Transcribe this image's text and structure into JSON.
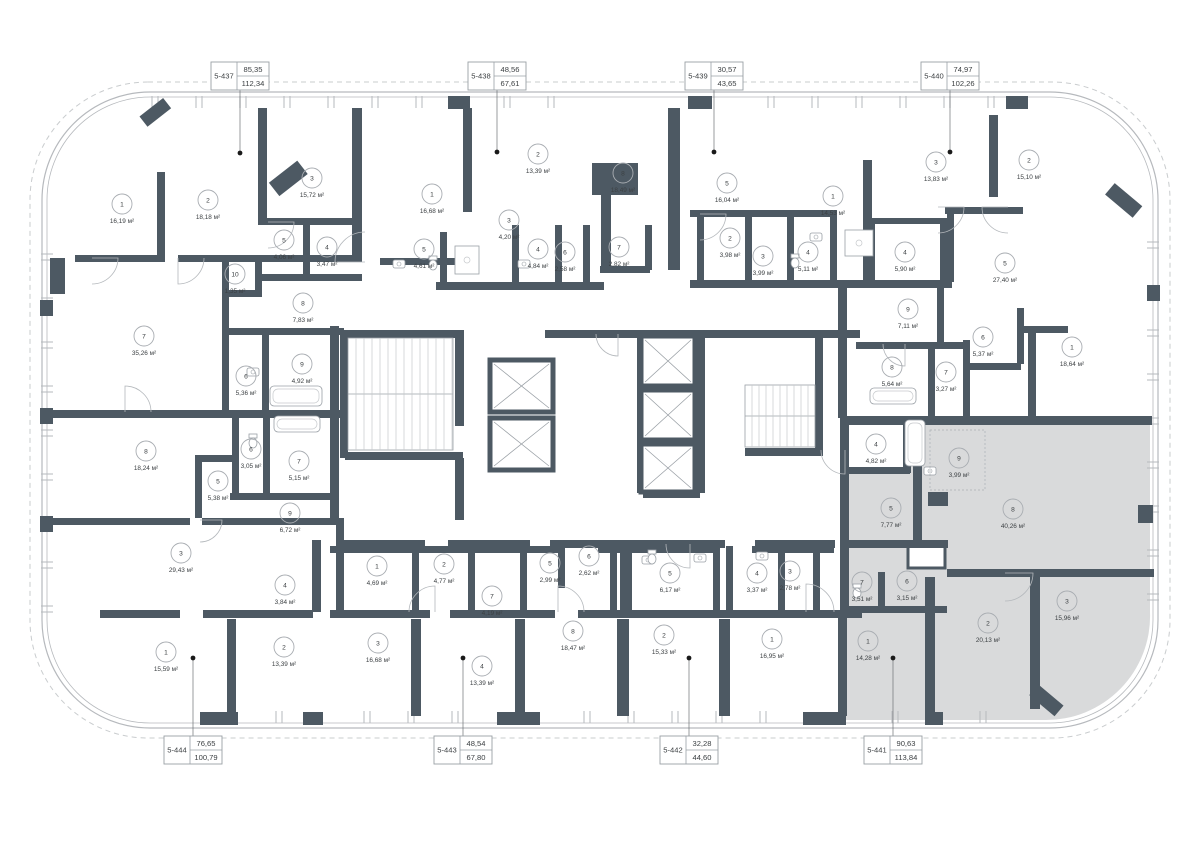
{
  "plan": {
    "unit": "м²",
    "highlight_color": "#d9dadb",
    "wall_color": "#4d5963",
    "apartments": [
      {
        "id": "5-437",
        "area_top": "85,35",
        "area_bottom": "112,34",
        "side": "top",
        "cx": 240,
        "dot_y": 153,
        "highlighted": false
      },
      {
        "id": "5-438",
        "area_top": "48,56",
        "area_bottom": "67,61",
        "side": "top",
        "cx": 497,
        "dot_y": 152,
        "highlighted": false
      },
      {
        "id": "5-439",
        "area_top": "30,57",
        "area_bottom": "43,65",
        "side": "top",
        "cx": 714,
        "dot_y": 152,
        "highlighted": false
      },
      {
        "id": "5-440",
        "area_top": "74,97",
        "area_bottom": "102,26",
        "side": "top",
        "cx": 950,
        "dot_y": 152,
        "highlighted": false
      },
      {
        "id": "5-444",
        "area_top": "76,65",
        "area_bottom": "100,79",
        "side": "bottom",
        "cx": 193,
        "dot_y": 658,
        "highlighted": false
      },
      {
        "id": "5-443",
        "area_top": "48,54",
        "area_bottom": "67,80",
        "side": "bottom",
        "cx": 463,
        "dot_y": 658,
        "highlighted": false
      },
      {
        "id": "5-442",
        "area_top": "32,28",
        "area_bottom": "44,60",
        "side": "bottom",
        "cx": 689,
        "dot_y": 658,
        "highlighted": false
      },
      {
        "id": "5-441",
        "area_top": "90,63",
        "area_bottom": "113,84",
        "side": "bottom",
        "cx": 893,
        "dot_y": 658,
        "highlighted": true
      }
    ],
    "rooms": [
      {
        "n": "1",
        "a": "16,19",
        "x": 122,
        "y": 204,
        "h": false
      },
      {
        "n": "2",
        "a": "18,18",
        "x": 208,
        "y": 200,
        "h": false
      },
      {
        "n": "3",
        "a": "15,72",
        "x": 312,
        "y": 178,
        "h": false
      },
      {
        "n": "5",
        "a": "4,06",
        "x": 284,
        "y": 240,
        "h": false
      },
      {
        "n": "4",
        "a": "3,47",
        "x": 327,
        "y": 247,
        "h": false
      },
      {
        "n": "10",
        "a": "1,35",
        "x": 235,
        "y": 274,
        "h": false
      },
      {
        "n": "8",
        "a": "7,83",
        "x": 303,
        "y": 303,
        "h": false
      },
      {
        "n": "1",
        "a": "16,68",
        "x": 432,
        "y": 194,
        "h": false
      },
      {
        "n": "5",
        "a": "4,61",
        "x": 424,
        "y": 249,
        "h": false
      },
      {
        "n": "2",
        "a": "13,39",
        "x": 538,
        "y": 154,
        "h": false
      },
      {
        "n": "3",
        "a": "4,20",
        "x": 509,
        "y": 220,
        "h": false
      },
      {
        "n": "4",
        "a": "4,84",
        "x": 538,
        "y": 249,
        "h": false
      },
      {
        "n": "6",
        "a": "2,58",
        "x": 565,
        "y": 252,
        "h": false
      },
      {
        "n": "8",
        "a": "18,49",
        "x": 623,
        "y": 173,
        "h": false
      },
      {
        "n": "7",
        "a": "2,82",
        "x": 619,
        "y": 247,
        "h": false
      },
      {
        "n": "5",
        "a": "16,04",
        "x": 727,
        "y": 183,
        "h": false
      },
      {
        "n": "2",
        "a": "3,98",
        "x": 730,
        "y": 238,
        "h": false
      },
      {
        "n": "3",
        "a": "3,99",
        "x": 763,
        "y": 256,
        "h": false
      },
      {
        "n": "4",
        "a": "5,11",
        "x": 808,
        "y": 252,
        "h": false
      },
      {
        "n": "1",
        "a": "14,53",
        "x": 833,
        "y": 196,
        "h": false
      },
      {
        "n": "4",
        "a": "5,90",
        "x": 905,
        "y": 252,
        "h": false
      },
      {
        "n": "3",
        "a": "13,83",
        "x": 936,
        "y": 162,
        "h": false
      },
      {
        "n": "2",
        "a": "15,10",
        "x": 1029,
        "y": 160,
        "h": false
      },
      {
        "n": "5",
        "a": "27,40",
        "x": 1005,
        "y": 263,
        "h": false
      },
      {
        "n": "9",
        "a": "7,11",
        "x": 908,
        "y": 309,
        "h": false
      },
      {
        "n": "6",
        "a": "5,37",
        "x": 983,
        "y": 337,
        "h": false
      },
      {
        "n": "1",
        "a": "18,64",
        "x": 1072,
        "y": 347,
        "h": false
      },
      {
        "n": "8",
        "a": "5,64",
        "x": 892,
        "y": 367,
        "h": false
      },
      {
        "n": "7",
        "a": "3,27",
        "x": 946,
        "y": 372,
        "h": false
      },
      {
        "n": "7",
        "a": "35,26",
        "x": 144,
        "y": 336,
        "h": false
      },
      {
        "n": "6",
        "a": "5,36",
        "x": 246,
        "y": 376,
        "h": false
      },
      {
        "n": "9",
        "a": "4,92",
        "x": 302,
        "y": 364,
        "h": false
      },
      {
        "n": "8",
        "a": "18,24",
        "x": 146,
        "y": 451,
        "h": false
      },
      {
        "n": "6",
        "a": "3,05",
        "x": 251,
        "y": 449,
        "h": false
      },
      {
        "n": "7",
        "a": "5,15",
        "x": 299,
        "y": 461,
        "h": false
      },
      {
        "n": "5",
        "a": "5,38",
        "x": 218,
        "y": 481,
        "h": false
      },
      {
        "n": "9",
        "a": "6,72",
        "x": 290,
        "y": 513,
        "h": false
      },
      {
        "n": "3",
        "a": "29,43",
        "x": 181,
        "y": 553,
        "h": false
      },
      {
        "n": "4",
        "a": "3,84",
        "x": 285,
        "y": 585,
        "h": false
      },
      {
        "n": "1",
        "a": "15,59",
        "x": 166,
        "y": 652,
        "h": false
      },
      {
        "n": "2",
        "a": "13,39",
        "x": 284,
        "y": 647,
        "h": false
      },
      {
        "n": "1",
        "a": "4,69",
        "x": 377,
        "y": 566,
        "h": false
      },
      {
        "n": "2",
        "a": "4,77",
        "x": 444,
        "y": 564,
        "h": false
      },
      {
        "n": "7",
        "a": "4,19",
        "x": 492,
        "y": 596,
        "h": false
      },
      {
        "n": "5",
        "a": "2,99",
        "x": 550,
        "y": 563,
        "h": false
      },
      {
        "n": "6",
        "a": "2,62",
        "x": 589,
        "y": 556,
        "h": false
      },
      {
        "n": "5",
        "a": "6,17",
        "x": 670,
        "y": 573,
        "h": false
      },
      {
        "n": "4",
        "a": "3,37",
        "x": 757,
        "y": 573,
        "h": false
      },
      {
        "n": "3",
        "a": "2,78",
        "x": 790,
        "y": 571,
        "h": false
      },
      {
        "n": "3",
        "a": "16,68",
        "x": 378,
        "y": 643,
        "h": false
      },
      {
        "n": "4",
        "a": "13,39",
        "x": 482,
        "y": 666,
        "h": false
      },
      {
        "n": "8",
        "a": "18,47",
        "x": 573,
        "y": 631,
        "h": false
      },
      {
        "n": "2",
        "a": "15,33",
        "x": 664,
        "y": 635,
        "h": false
      },
      {
        "n": "1",
        "a": "16,95",
        "x": 772,
        "y": 639,
        "h": false
      },
      {
        "n": "4",
        "a": "4,82",
        "x": 876,
        "y": 444,
        "h": true
      },
      {
        "n": "9",
        "a": "3,99",
        "x": 959,
        "y": 458,
        "h": true
      },
      {
        "n": "5",
        "a": "7,77",
        "x": 891,
        "y": 508,
        "h": true
      },
      {
        "n": "8",
        "a": "40,26",
        "x": 1013,
        "y": 509,
        "h": true
      },
      {
        "n": "7",
        "a": "3,51",
        "x": 862,
        "y": 582,
        "h": true
      },
      {
        "n": "6",
        "a": "3,15",
        "x": 907,
        "y": 581,
        "h": true
      },
      {
        "n": "1",
        "a": "14,28",
        "x": 868,
        "y": 641,
        "h": true
      },
      {
        "n": "2",
        "a": "20,13",
        "x": 988,
        "y": 623,
        "h": true
      },
      {
        "n": "3",
        "a": "15,96",
        "x": 1067,
        "y": 601,
        "h": true
      }
    ]
  }
}
